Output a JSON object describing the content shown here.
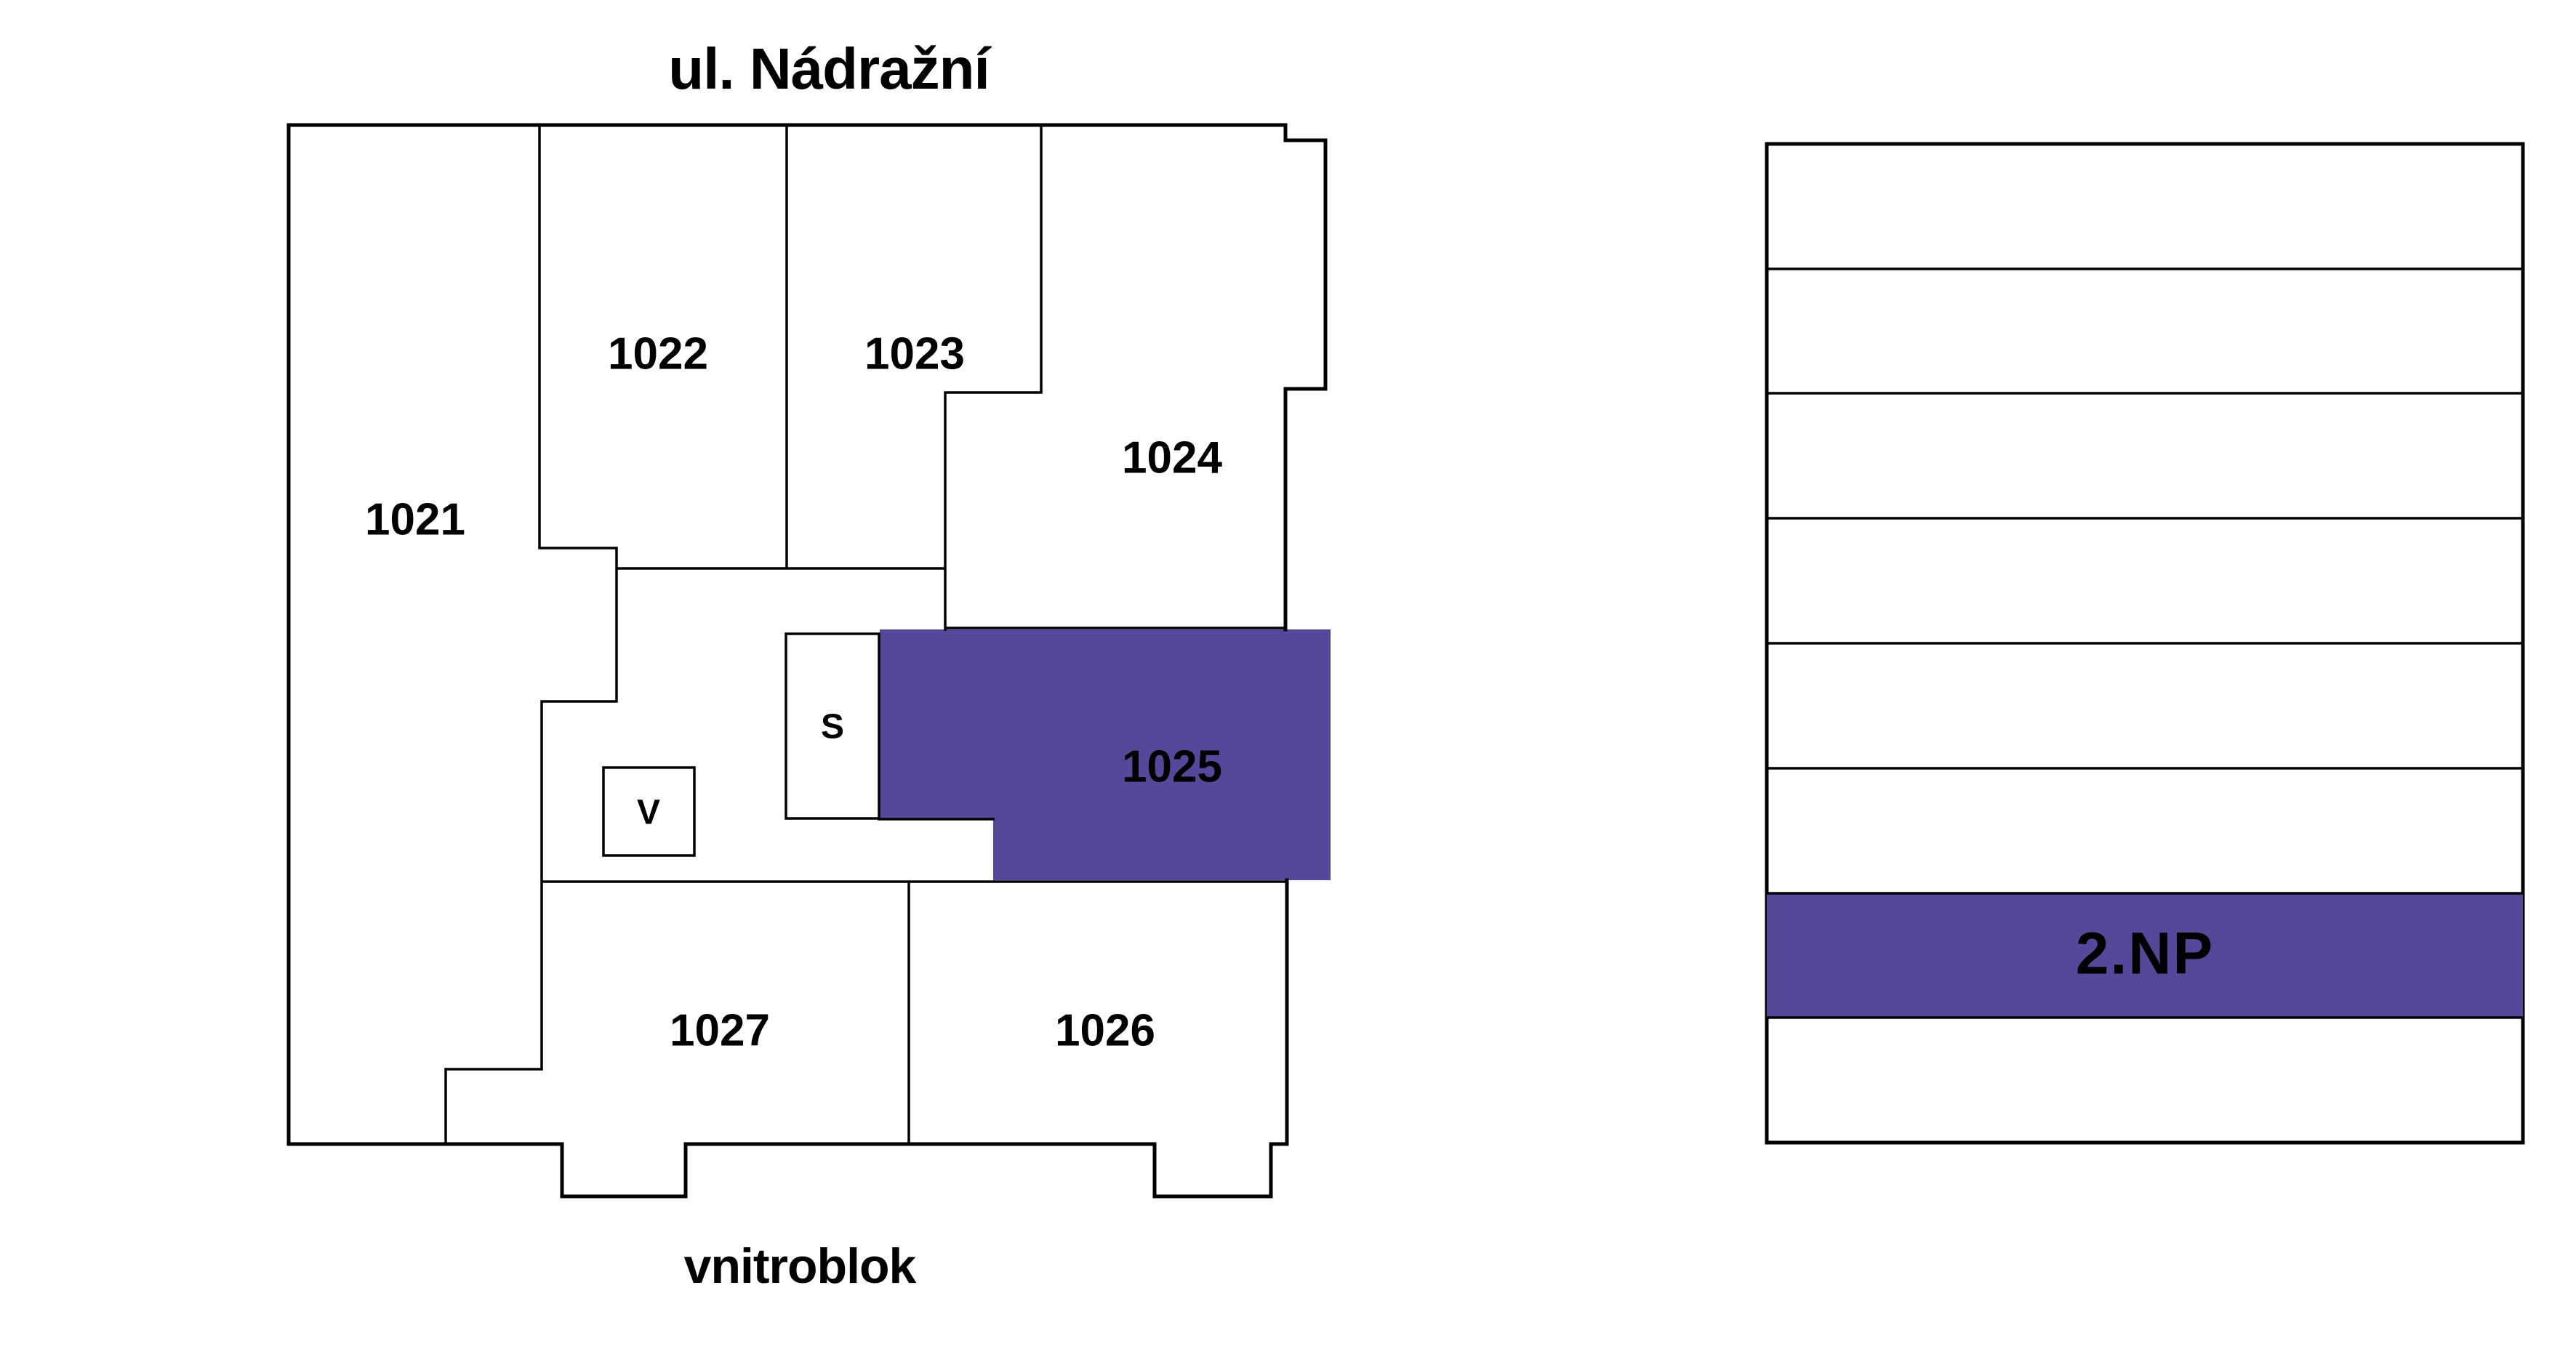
{
  "plan": {
    "street_label": "ul. Nádražní",
    "courtyard_label": "vnitroblok",
    "units": {
      "u1021": "1021",
      "u1022": "1022",
      "u1023": "1023",
      "u1024": "1024",
      "u1025": "1025",
      "u1026": "1026",
      "u1027": "1027"
    },
    "service_rooms": {
      "v_label": "V",
      "s_label": "S"
    },
    "highlighted_unit": "1025"
  },
  "floor_stack": {
    "floors_total": 8,
    "highlighted_floor_label": "2.NP",
    "highlighted_row_from_bottom": 2
  },
  "colors": {
    "highlight": "#54489A",
    "highlight_text": "#FFFFFF",
    "outline": "#000000",
    "background": "#FFFFFF"
  }
}
